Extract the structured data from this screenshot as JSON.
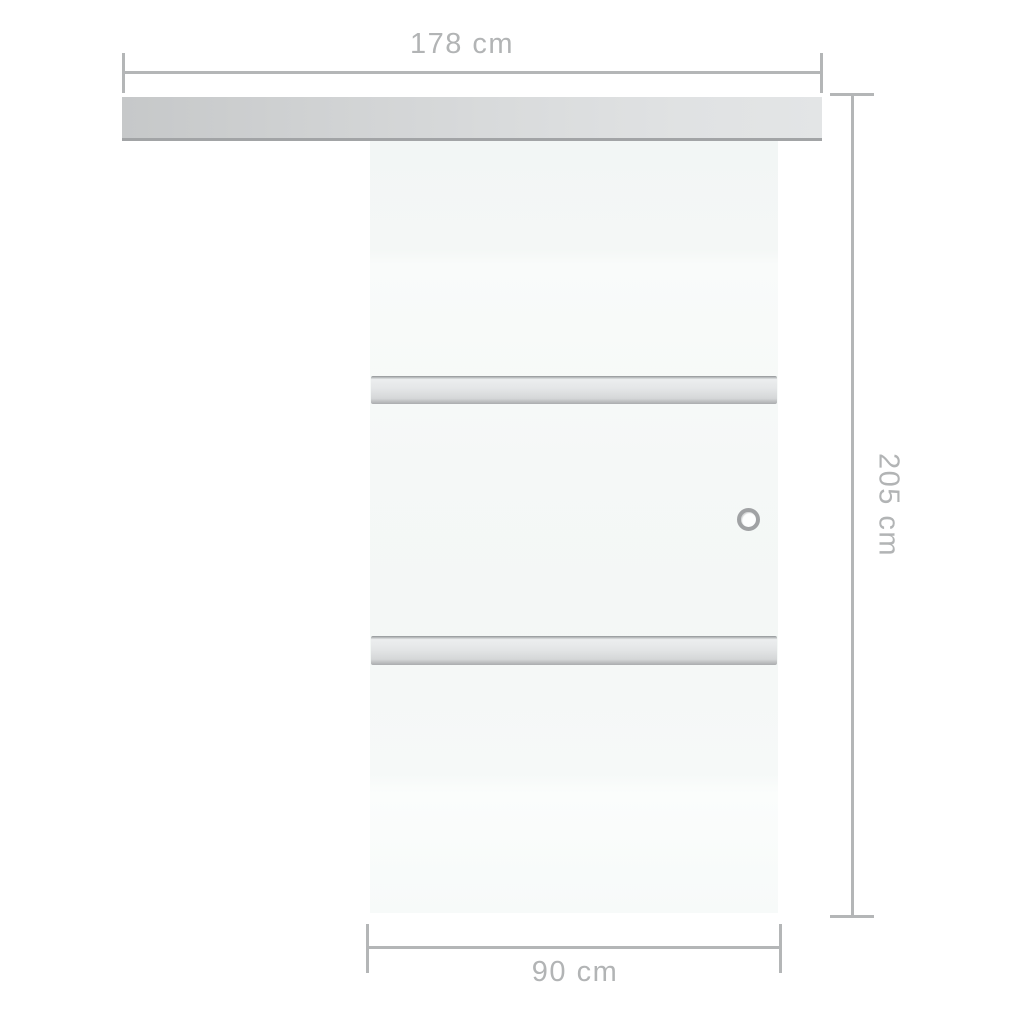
{
  "dimensions": {
    "top": {
      "label": "178 cm",
      "measures": "rail-width"
    },
    "right": {
      "label": "205 cm",
      "measures": "door-height"
    },
    "bottom": {
      "label": "90 cm",
      "measures": "door-width"
    }
  },
  "product": {
    "type": "sliding-glass-door",
    "parts": [
      "sliding-rail",
      "glass-door-panel",
      "upper-crossbar",
      "lower-crossbar",
      "ring-handle"
    ]
  },
  "colors": {
    "background": "#ffffff",
    "dimension_line": "#b4b6b7",
    "dimension_text": "#b2b4b5",
    "rail_dark": "#c6c8c9",
    "rail_light": "#e3e5e6",
    "rail_bottom_edge": "#a2a4a6",
    "glass": "#f5f8f7",
    "crossbar_light": "#eceeef",
    "crossbar_dark": "#aaacae",
    "handle_ring": "#a0a2a4"
  }
}
